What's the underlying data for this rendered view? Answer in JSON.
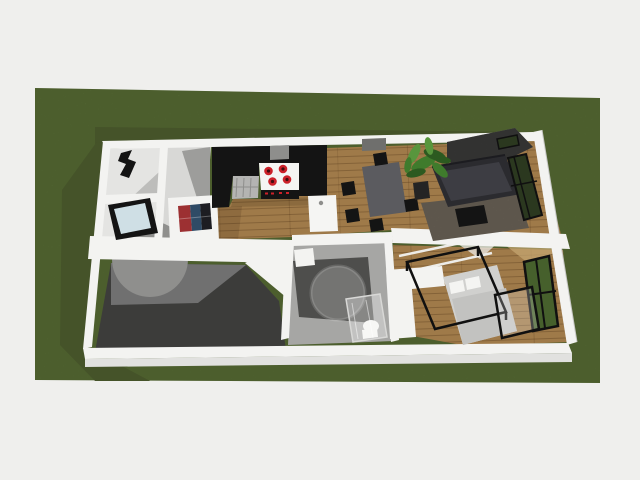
{
  "scene": {
    "type": "3d-floorplan-render",
    "view": "aerial-dollhouse-perspective",
    "ground": "grass-lot",
    "rooms": [
      "entry",
      "storage-room",
      "utility-room",
      "kitchen",
      "dining-area",
      "living-room",
      "bathroom",
      "bedroom",
      "carport"
    ],
    "furniture": [
      "wardrobe",
      "coat-rack",
      "glass-top-table",
      "round-table",
      "entry-art-rug",
      "tall-black-cabinets",
      "range-hood",
      "cooktop",
      "sink-dishwasher-run",
      "kitchen-island",
      "dining-table",
      "dining-chairs",
      "sideboard",
      "potted-plant",
      "stone-feature-wall",
      "sofa",
      "area-rug",
      "coffee-table",
      "corner-window",
      "washbasin",
      "round-bathtub",
      "walk-in-shower",
      "toilet",
      "double-bed",
      "pillows",
      "black-canopy-frame",
      "built-in-closet",
      "glass-door"
    ]
  },
  "palette": {
    "bg": "#efefed",
    "grass": "#5b7137",
    "grassShadow": "#455329",
    "wall": "#f3f3f1",
    "wallFace": "#e1e1df",
    "wood": "#9f7a49",
    "floorLight": "#e4e4e2",
    "floorEntry": "#d8d8d6",
    "floorShadow": "#9d9d9b",
    "black": "#141414",
    "steel": "#b4b4b2",
    "steelDark": "#8e8e8c",
    "counter": "#f5f5f3",
    "burner": "#cc2129",
    "burnerCore": "#420d10",
    "glassPale": "#cfdfe5",
    "glassDark": "#2b381f",
    "glassGreen": "#46602c",
    "slab": "#3c3c3a",
    "slabLight": "#707070",
    "bathFloor": "#a6a6a4",
    "tileDark": "#4e4e4c",
    "tub": "#747472",
    "rug": "#7d7466",
    "stone": "#a2a2a0",
    "sofa": "#2b2b2f",
    "sofaSeat": "#3d3d43",
    "table": "#5b5b5f",
    "leafDark": "#2c5a20",
    "leaf": "#3f7b2c",
    "leafLight": "#58963d",
    "pot": "#242424",
    "bed": "#d0d0ce",
    "bedShade": "#c2c2c0",
    "pillow": "#f4f4f2",
    "frame": "#101010",
    "roundGray": "#8f8f8d",
    "buffet": "#6f6f6d",
    "beam": "#edece8",
    "roofTan": "#c8a873",
    "artRed": "#9c3032",
    "artNavy": "#2f4b66",
    "artDark": "#1d1d22"
  }
}
